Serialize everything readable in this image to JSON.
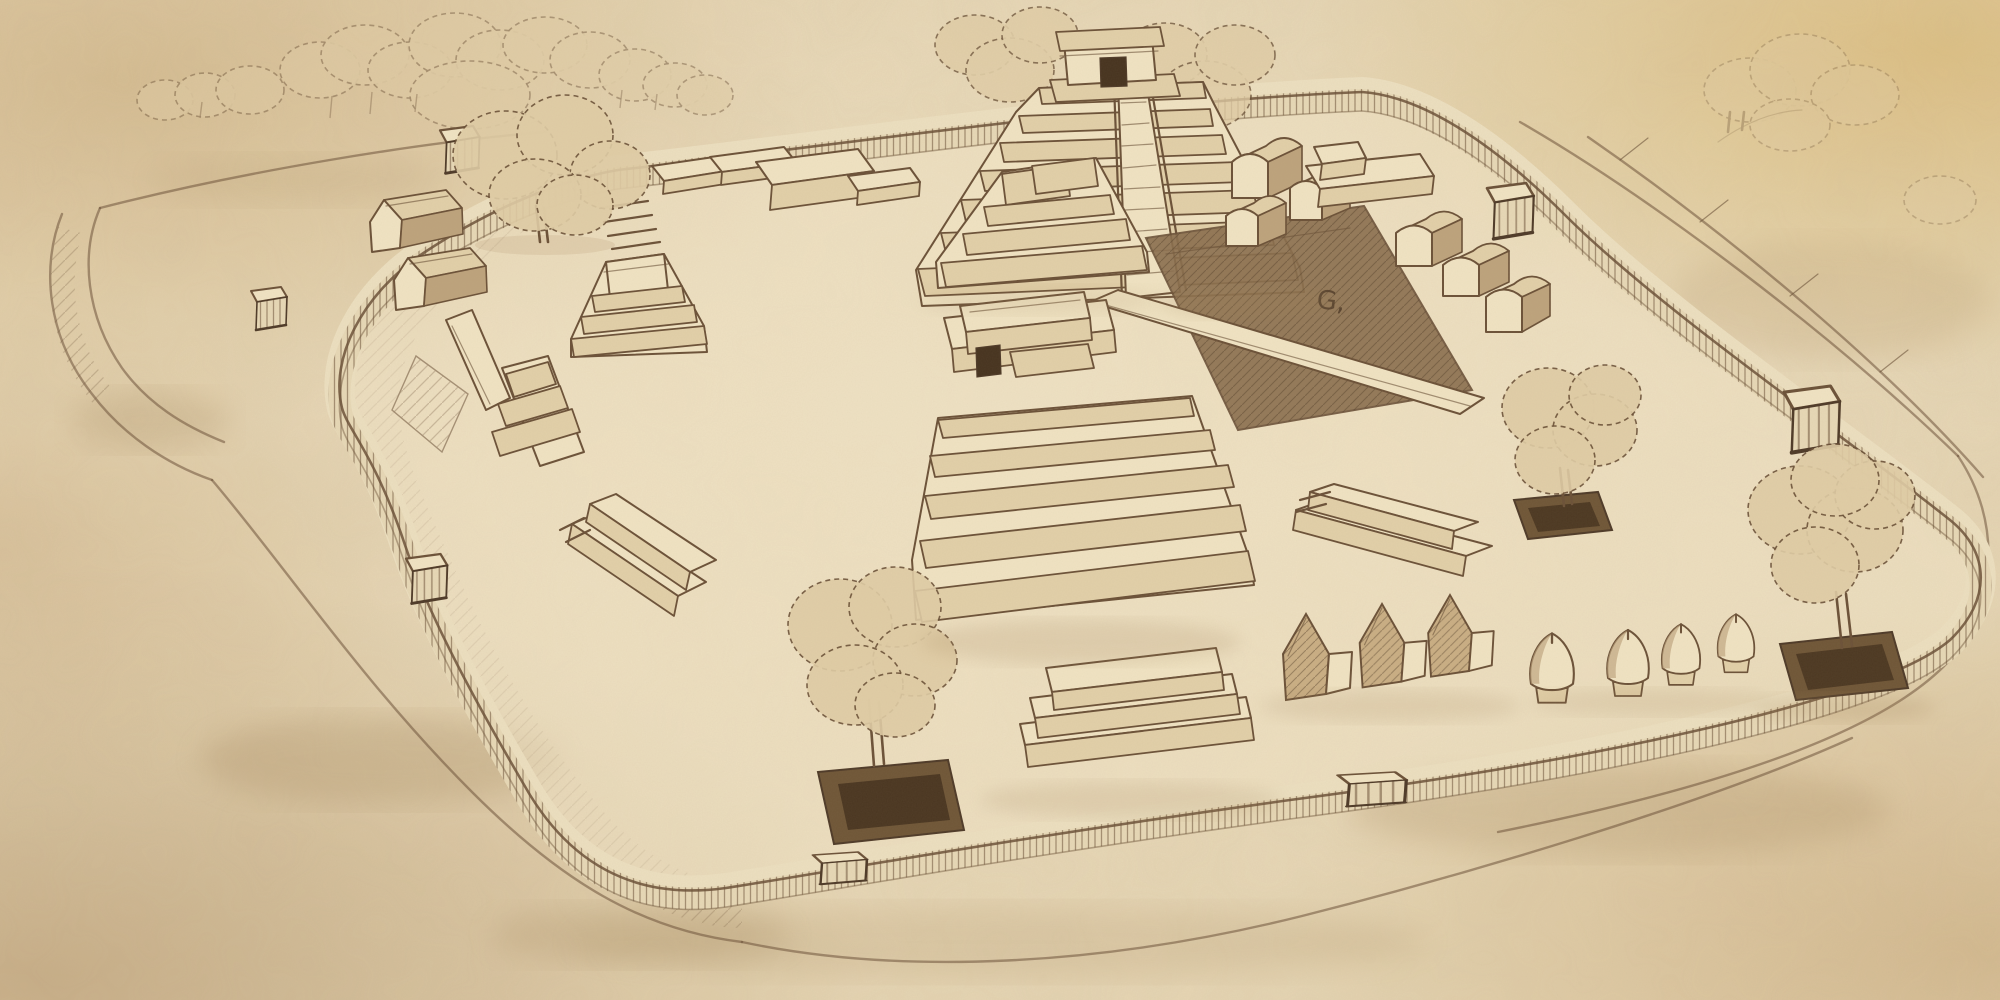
{
  "artwork": {
    "type": "pencil-sketch-illustration",
    "subject": "Bird's-eye artist reconstruction of an ancient walled city: stepped pyramids, temples, houses, granaries and trees inside a rounded palisade wall ringed by an earthwork moat",
    "medium_look": "sepia pencil on aged, stained paper",
    "glyph": {
      "text": "G,"
    },
    "palette": {
      "paper": "#e6d6b4",
      "paper_light": "#f2e6ca",
      "paper_shade": "#cdb68c",
      "stain_warm": "#d6b266",
      "stain_dark": "#ad8d64",
      "ink": "#6b5138",
      "ink_dark": "#4e3a28",
      "face_light": "#f0e3c3",
      "face_front": "#e2d0a9",
      "face_shade": "#bda37c",
      "canopy": "#e0cda6",
      "court_dark": "#8a6e4e",
      "planter_dark": "#6f5637",
      "door_dark": "#46331f",
      "shadow": "#a08257"
    }
  },
  "scene": {
    "inventory": [
      {
        "name": "paper-background",
        "label": "Aged stained paper"
      },
      {
        "name": "outer-earthworks",
        "label": "Outer earthwork bank and moat ring"
      },
      {
        "name": "moat-ditch",
        "label": "Hatched moat ditch"
      },
      {
        "name": "palisade-wall",
        "label": "Palisade wall around the plaza"
      },
      {
        "name": "plaza-ground",
        "label": "Inner plaza ground"
      },
      {
        "name": "great-pyramid",
        "label": "Great stepped pyramid with summit temple and stair"
      },
      {
        "name": "pyramid-temple",
        "label": "Summit temple with doorway"
      },
      {
        "name": "pyramid-staircase",
        "label": "Great stair of the pyramid"
      },
      {
        "name": "terrace-platform",
        "label": "Terraced platform at pyramid base"
      },
      {
        "name": "central-temple",
        "label": "Central long temple building"
      },
      {
        "name": "central-pyramid",
        "label": "Central stepped pyramid platform"
      },
      {
        "name": "sunken-court",
        "label": "Dark sunken court"
      },
      {
        "name": "court-glyph",
        "label": "Small glyph mark beside the court"
      },
      {
        "name": "causeway",
        "label": "Raised causeway ramp"
      },
      {
        "name": "vaulted-buildings",
        "label": "Row of vaulted (barrel-roof) buildings"
      },
      {
        "name": "platform-with-shrine",
        "label": "Platform with small shrine block"
      },
      {
        "name": "northwest-platforms",
        "label": "Row of low platforms, north-west"
      },
      {
        "name": "northwest-houses",
        "label": "Pair of gabled houses, north-west"
      },
      {
        "name": "west-altar",
        "label": "Stepped altar with tall block, west"
      },
      {
        "name": "center-altar-group",
        "label": "Altar group with ramp, centre-west"
      },
      {
        "name": "southwest-platform",
        "label": "Long low platform, south-west"
      },
      {
        "name": "south-platform",
        "label": "Three-tier platform, south"
      },
      {
        "name": "east-platform",
        "label": "Long low platform, east"
      },
      {
        "name": "south-houses",
        "label": "Row of thatched gabled houses, south"
      },
      {
        "name": "granaries",
        "label": "Row of four beehive granaries"
      },
      {
        "name": "gate-north",
        "label": "Gate hut on north wall"
      },
      {
        "name": "gate-west-outer",
        "label": "Gate hut on west bank"
      },
      {
        "name": "gate-west",
        "label": "Gate hut on west wall"
      },
      {
        "name": "gate-east-upper",
        "label": "Gate hut on east wall (upper)"
      },
      {
        "name": "gate-east-lower",
        "label": "Gate hut on east wall (lower)"
      },
      {
        "name": "gate-south-east",
        "label": "Gate on south wall (east)"
      },
      {
        "name": "gate-south-west",
        "label": "Gate on south wall (west)"
      },
      {
        "name": "forest-northwest",
        "label": "Forest beyond the north-west wall"
      },
      {
        "name": "tree-plaza-northwest",
        "label": "Large tree inside north-west plaza"
      },
      {
        "name": "trees-behind-pyramid",
        "label": "Trees behind the great pyramid"
      },
      {
        "name": "tree-south-planter",
        "label": "Tree in square planter, south plaza"
      },
      {
        "name": "tree-east-planter-1",
        "label": "Tree in square planter, east plaza"
      },
      {
        "name": "tree-east-planter-2",
        "label": "Tree in square planter, far east"
      },
      {
        "name": "trees-northeast-faint",
        "label": "Faint trees beyond north-east bank"
      },
      {
        "name": "ground-shadows",
        "label": "Soft pencil ground shading"
      }
    ]
  }
}
